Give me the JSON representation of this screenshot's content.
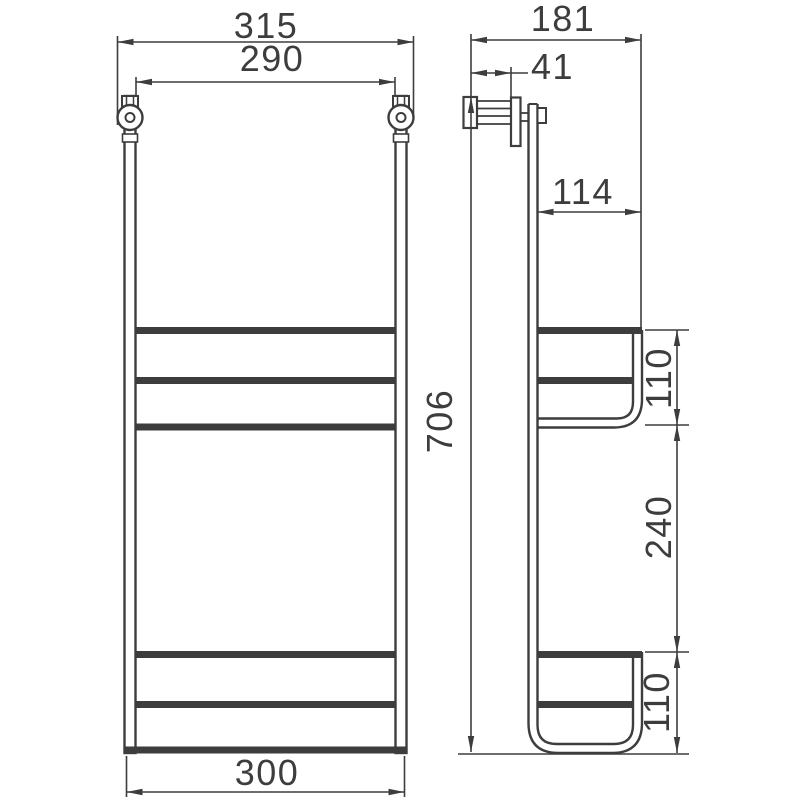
{
  "page": {
    "background_color": "#ffffff",
    "line_color": "#3d3d3d",
    "text_color": "#3d3d3d"
  },
  "drawing": {
    "description": "wall-mounted two-tier basket shelf, front view and side view with dimensions",
    "front_view": {
      "dim_overall_width": "315",
      "dim_rail_center_width": "290",
      "dim_bottom_width": "300",
      "dim_total_height": "706"
    },
    "side_view": {
      "dim_total_depth": "181",
      "dim_bracket_offset": "41",
      "dim_basket_depth": "114",
      "dim_upper_basket_height": "110",
      "dim_basket_spacing": "240",
      "dim_lower_basket_height": "110"
    }
  }
}
